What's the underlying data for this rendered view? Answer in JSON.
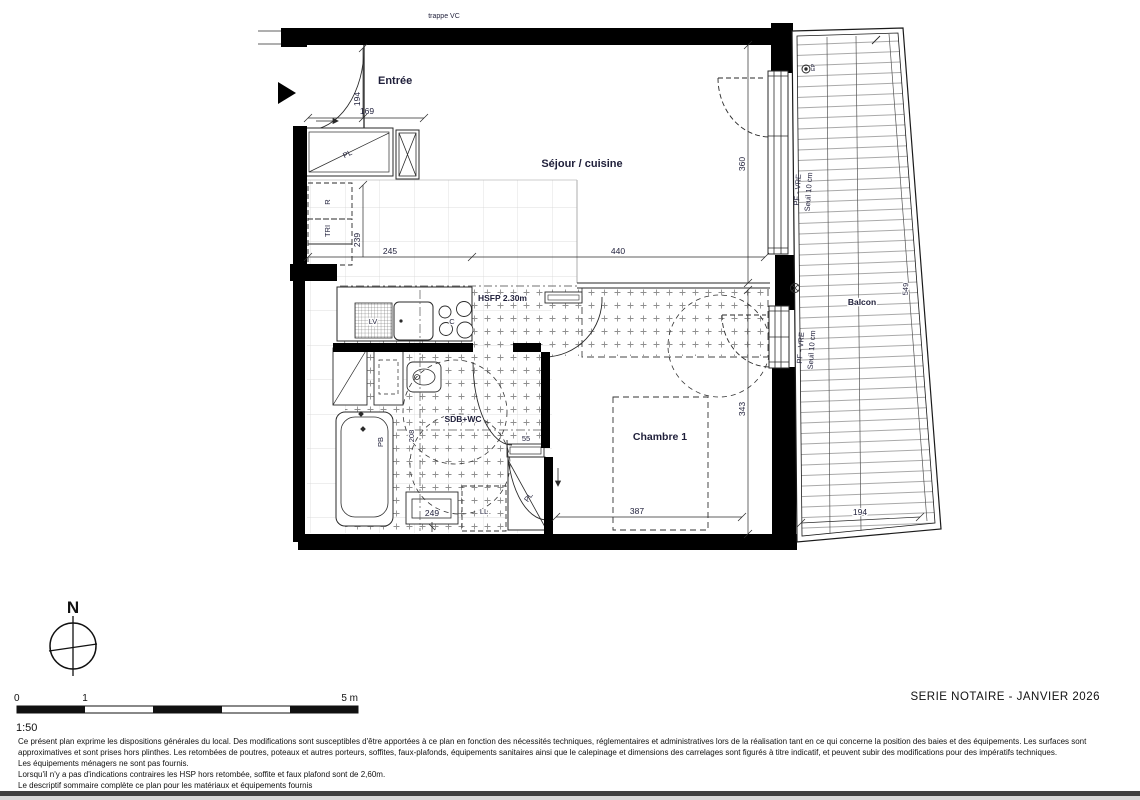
{
  "plan": {
    "trappe": "trappe VC",
    "rooms": {
      "entree": "Entrée",
      "sejour": "Séjour / cuisine",
      "sdb": "SDB+WC",
      "chambre": "Chambre 1",
      "balcon": "Balcon"
    },
    "annotations": {
      "hsfp": "HSFP 2.30m",
      "pf_vre_1": "PF - VRE",
      "seuil_1": "Seuil 10 cm",
      "pf_vre_2": "PF - VRE",
      "seuil_2": "Seuil 10 cm",
      "ep": "EP"
    },
    "fixtures": {
      "pl_entree": "PL",
      "r": "R",
      "tri": "TRI",
      "lv": "LV",
      "c": "C",
      "pb": "PB",
      "ll": "LL",
      "pl_chambre": "PL"
    },
    "dimensions": {
      "d194_entree": "194",
      "d169": "169",
      "d239": "239",
      "d245": "245",
      "d440": "440",
      "d360": "360",
      "d343": "343",
      "d387": "387",
      "d208": "208",
      "d249": "249",
      "d55": "55",
      "d549": "549",
      "d194_balcon": "194"
    },
    "compass": "N"
  },
  "scalebar": {
    "zero": "0",
    "one": "1",
    "five": "5 m",
    "ratio": "1:50"
  },
  "footer": {
    "serie": "SERIE NOTAIRE - JANVIER 2026",
    "disclaimer": [
      "Ce présent plan exprime les dispositions générales du local. Des modifications sont susceptibles d'être apportées à ce plan en fonction des nécessités techniques, réglementaires et administratives lors de la réalisation tant en ce qui concerne la position des baies et des équipements. Les surfaces sont",
      "approximatives et sont prises hors plinthes. Les retombées de poutres, poteaux et autres porteurs, soffites, faux-plafonds, équipements sanitaires ainsi que le calepinage et dimensions des carrelages sont figurés à titre indicatif, et peuvent subir des modifications pour des impératifs techniques.",
      "Les équipements ménagers ne sont pas fournis.",
      "Lorsqu'il n'y a pas d'indications contraires les HSP hors retombée, soffite et faux plafond sont de 2,60m.",
      "Le descriptif sommaire complète ce plan pour les matériaux et équipements fournis"
    ]
  }
}
